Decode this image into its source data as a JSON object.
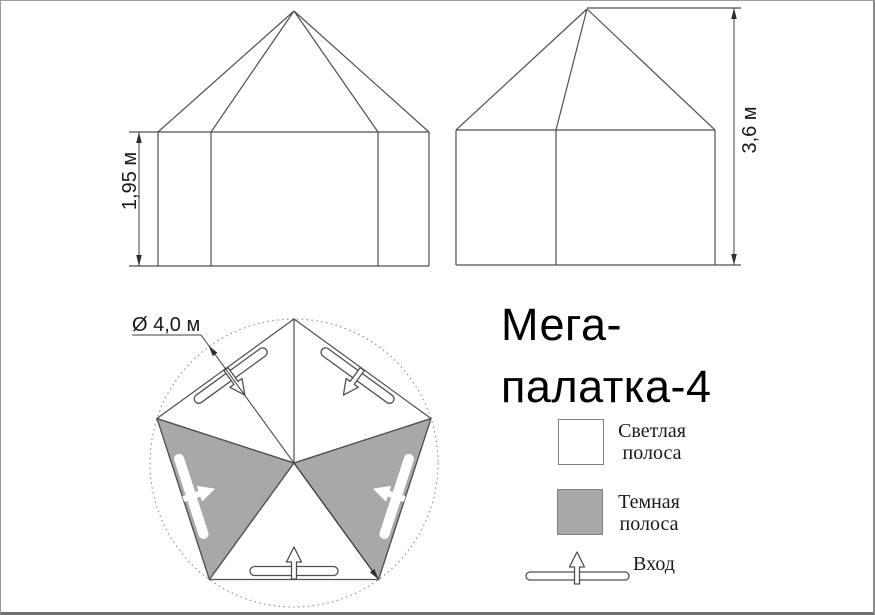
{
  "page": {
    "background": "#ffffff",
    "border_color": "#9c9c9c"
  },
  "colors": {
    "line": "#4f4f4f",
    "dark_stripe": "#a8a8a8",
    "light_stripe": "#ffffff",
    "swatch_border": "#808080",
    "text": "#1a1a1a"
  },
  "views": {
    "front": {
      "height_label": "1,95 м"
    },
    "side": {
      "height_label": "3,6 м"
    },
    "plan": {
      "diameter_label": "Ø 4,0 м"
    }
  },
  "title": {
    "line1": "Мега-",
    "line2": "палатка-4"
  },
  "legend": {
    "light_stripe": {
      "line1": "Светлая",
      "line2": "полоса"
    },
    "dark_stripe": {
      "line1": "Темная",
      "line2": "полоса"
    },
    "entrance_label": "Вход"
  }
}
